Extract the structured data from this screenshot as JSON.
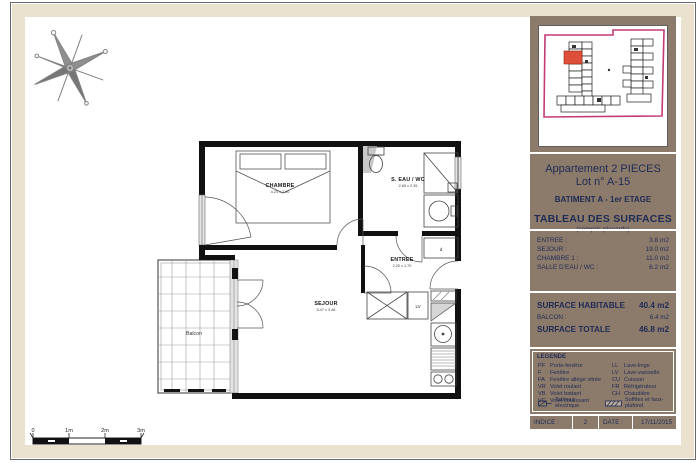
{
  "colors": {
    "sidebar_brown": "#8c7b6b",
    "text_navy": "#1e2b56",
    "mat_cream": "#eae2cf",
    "site_outline_pink": "#c43a76",
    "highlight_unit_red": "#dd4f38"
  },
  "sidebar": {
    "title_line1": "Appartement 2 PIECES",
    "title_line2": "Lot n° A-15",
    "building": "BATIMENT A - 1er ETAGE",
    "table_title": "TABLEAU DES SURFACES",
    "table_subtitle": "(compris placards)",
    "rooms": [
      {
        "label": "ENTREE :",
        "value": "3.8 m2"
      },
      {
        "label": "SEJOUR :",
        "value": "19.0 m2"
      },
      {
        "label": "CHAMBRE 1 :",
        "value": "11.0 m2"
      },
      {
        "label": "SALLE D'EAU / WC :",
        "value": "6.2 m2"
      }
    ],
    "surface_habitable_label": "SURFACE HABITABLE",
    "surface_habitable_value": "40.4 m2",
    "balcon_label": "BALCON :",
    "balcon_value": "6.4 m2",
    "surface_totale_label": "SURFACE TOTALE",
    "surface_totale_value": "46.8 m2",
    "legend": {
      "title": "LEGENDE",
      "left": [
        {
          "abbr": "PF",
          "label": "Porte-fenêtre"
        },
        {
          "abbr": "F",
          "label": "Fenêtre"
        },
        {
          "abbr": "FA",
          "label": "Fenêtre allège vitrée"
        },
        {
          "abbr": "VR",
          "label": "Volet roulant"
        },
        {
          "abbr": "VB",
          "label": "Volet battant"
        },
        {
          "abbr": "VC",
          "label": "Volet coulissant"
        }
      ],
      "right": [
        {
          "abbr": "LL",
          "label": "Lave-linge"
        },
        {
          "abbr": "LV",
          "label": "Lave-vaisselle"
        },
        {
          "abbr": "CU",
          "label": "Cuisson"
        },
        {
          "abbr": "FR",
          "label": "Réfrigérateur"
        },
        {
          "abbr": "CH",
          "label": "Chaudière"
        }
      ],
      "tableau_electrique": "Tableau électrique",
      "soffites": "Soffites et faux-plafond"
    },
    "indice_label": "INDICE :",
    "indice_value": "2",
    "date_label": "DATE :",
    "date_value": "17/11/2015"
  },
  "plan": {
    "rooms": [
      {
        "name": "CHAMBRE",
        "dims": "4.20 x 2.60"
      },
      {
        "name": "S. EAU / WC",
        "dims": "2.65 x 2.35"
      },
      {
        "name": "ENTREE",
        "dims": "2.20 x 1.70"
      },
      {
        "name": "SEJOUR",
        "dims": "5.47 x 3.48"
      },
      {
        "name": "Balcon"
      }
    ],
    "labels": {
      "lv": "LV",
      "d": "d"
    },
    "scale": [
      "0",
      "1m",
      "2m",
      "3m"
    ]
  }
}
